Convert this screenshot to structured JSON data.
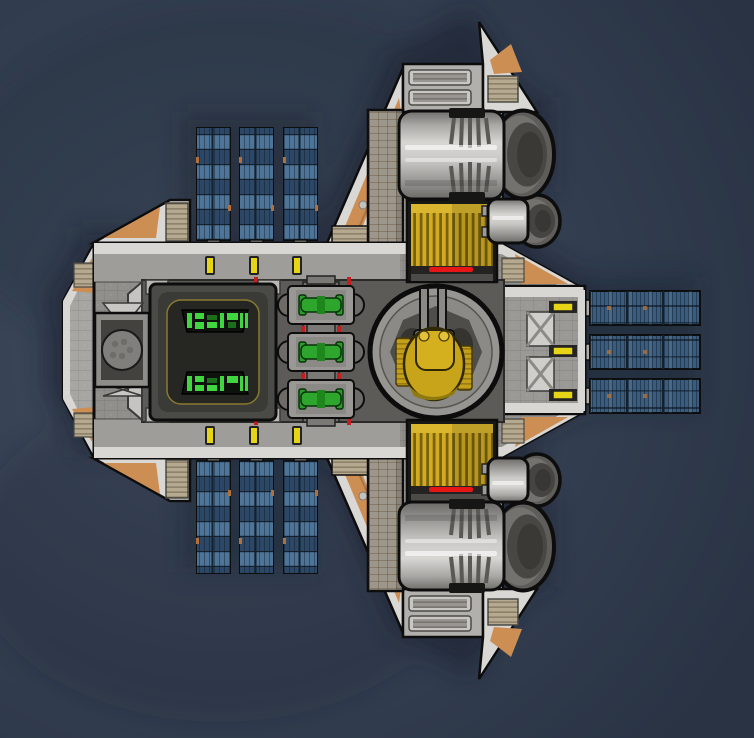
{
  "scene": {
    "type": "game",
    "view": "top-down-spaceship",
    "description": "Top-down view of a spaceship floating in dark space"
  },
  "colors": {
    "background": "#293344",
    "background_glow": "#414e61",
    "shadow": "#1c2432",
    "outline": "#0d0d0d",
    "hull_light": "#d8d7d4",
    "hull_mid": "#a7a6a2",
    "hull_floor": "#908f8b",
    "wing_white": "#d9d8d5",
    "accent_orange": "#cd8e54",
    "panel_tan": "#b5a98f",
    "pylon_tan": "#9d968b",
    "solar_base": "#3b5c7d",
    "solar_dark": "#2c4866",
    "solar_light": "#4e7598",
    "solar_frame": "#15202d",
    "solar_tick_orange": "#b0713c",
    "light_yellow": "#e6d417",
    "cargo_frame": "#181817",
    "cargo_gold": "#d3ab22",
    "cargo_gold_dark": "#77620e",
    "cargo_gold_band": "#d9b62e",
    "indicator_red": "#e51616",
    "engine_dark": "#6e6d6a",
    "engine_mid": "#a9a8a5",
    "engine_hi": "#d7d6d3",
    "nozzle_ring": "#5e5d59",
    "nozzle_rim": "#73726e",
    "nozzle_face": "#484744",
    "nozzle_core": "#3a3936",
    "machine_green": "#2ea62e",
    "machine_green_dark": "#1d871d",
    "module_gray": "#999894",
    "rail_gray": "#6f6e6a",
    "display_green": "#3fd63f",
    "display_bg": "#0d120c",
    "room_outer": "#4a4a46",
    "room_inner": "#262623",
    "trim_amber": "#8a7a30",
    "platform_gray": "#5c5b57",
    "turret_gold": "#c7a41a",
    "turret_gold_light": "#d4af1e",
    "turret_gold_dark": "#8f7a10",
    "barrel_gray": "#8a8986",
    "pad_gray": "#969591",
    "pad_inner": "#8b8a86",
    "octagon_gray": "#4e4d49",
    "stern_plate": "#9a9996",
    "brace_light": "#cfcecb",
    "connector_gray": "#b2b1ad",
    "hatch_gray": "#807f7b",
    "red_dot": "#c02020"
  },
  "ship": {
    "modules": {
      "solar_arrays": [
        {
          "id": "solar-array-top",
          "panels": 3,
          "orientation": "vertical"
        },
        {
          "id": "solar-array-bottom",
          "panels": 3,
          "orientation": "vertical"
        },
        {
          "id": "solar-array-right",
          "panels": 3,
          "orientation": "horizontal"
        }
      ],
      "engines": [
        {
          "id": "engine-large-top"
        },
        {
          "id": "engine-small-top"
        },
        {
          "id": "engine-large-bottom"
        },
        {
          "id": "engine-small-bottom"
        }
      ],
      "cargo_containers": [
        {
          "id": "cargo-container-top",
          "indicator": "red"
        },
        {
          "id": "cargo-container-bottom",
          "indicator": "red"
        }
      ],
      "turret": {
        "id": "gun-turret",
        "barrels": 2
      },
      "computer_core": {
        "id": "computer-core",
        "displays": 2
      },
      "conduits": {
        "id": "power-conduits",
        "modules": 3
      },
      "airlock": {
        "id": "airlock",
        "hatch": "circular"
      }
    },
    "hull_lights": {
      "top": 3,
      "bottom": 3,
      "stern": 3
    }
  }
}
